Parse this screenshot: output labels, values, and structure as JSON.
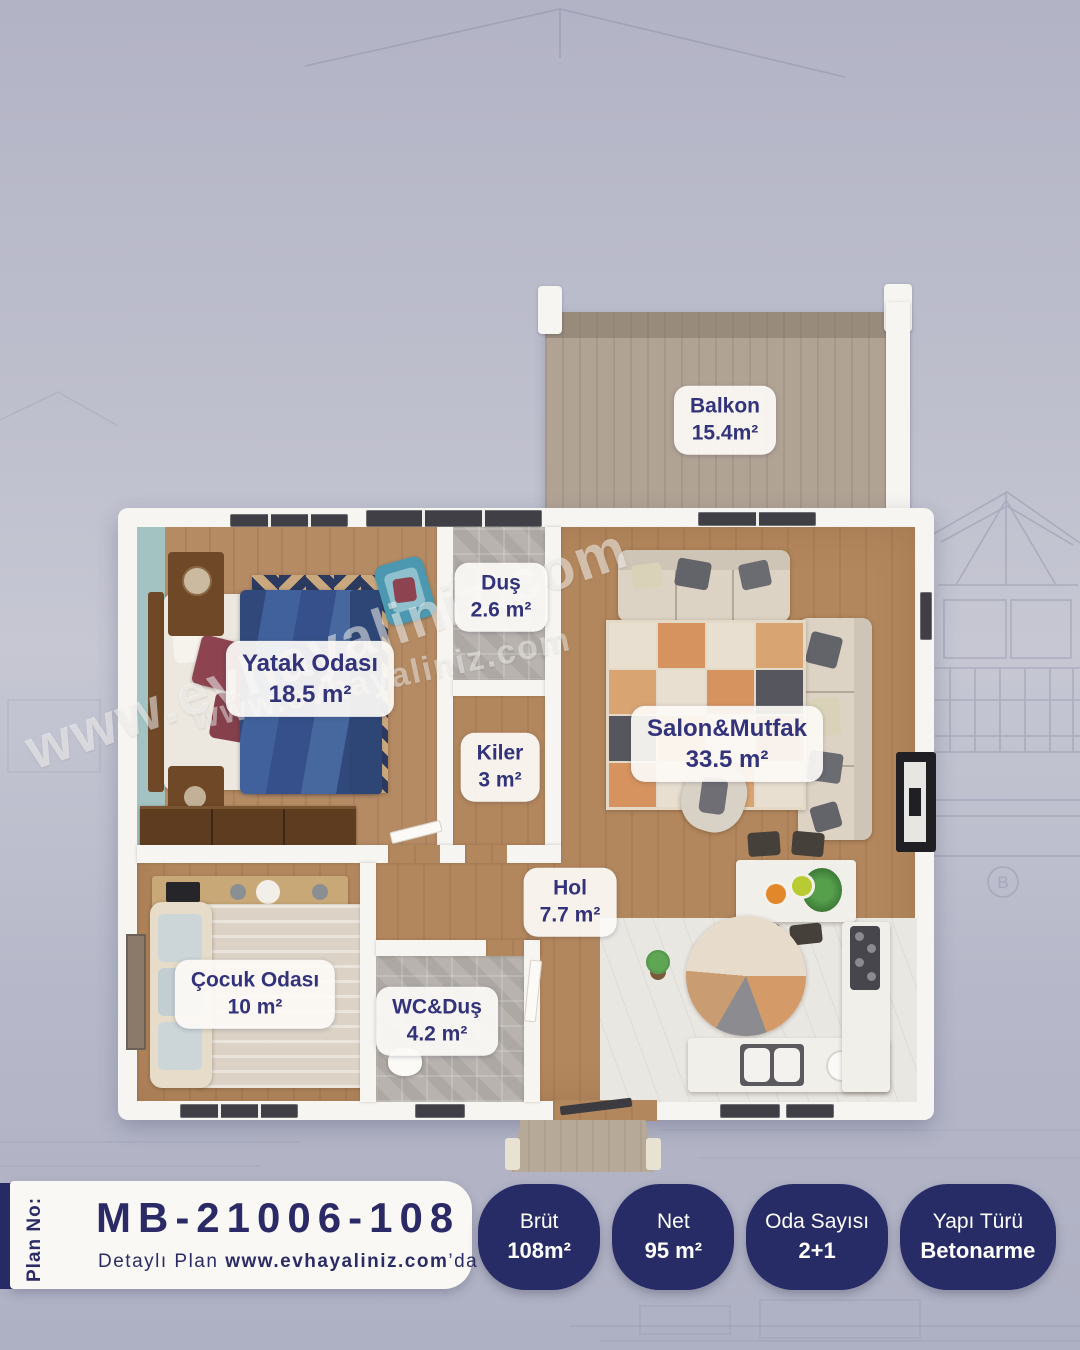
{
  "watermarks": {
    "large": "www.evhayaliniz.com",
    "small": "www.evhayaliniz.com"
  },
  "plan": {
    "rooms": [
      {
        "name": "Balkon",
        "area": "15.4m²"
      },
      {
        "name": "Duş",
        "area": "2.6 m²"
      },
      {
        "name": "Yatak Odası",
        "area": "18.5 m²"
      },
      {
        "name": "Kiler",
        "area": "3 m²"
      },
      {
        "name": "Salon&Mutfak",
        "area": "33.5 m²"
      },
      {
        "name": "Hol",
        "area": "7.7 m²"
      },
      {
        "name": "Çocuk Odası",
        "area": "10 m²"
      },
      {
        "name": "WC&Duş",
        "area": "4.2 m²"
      }
    ]
  },
  "footer": {
    "plan_no_label": "Plan No:",
    "plan_code": "MB-21006-108",
    "detail_prefix": "Detaylı Plan ",
    "detail_site": "www.evhayaliniz.com",
    "detail_suffix": "’da",
    "stats": [
      {
        "label": "Brüt",
        "value": "108m²"
      },
      {
        "label": "Net",
        "value": "95 m²"
      },
      {
        "label": "Oda Sayısı",
        "value": "2+1"
      },
      {
        "label": "Yapı Türü",
        "value": "Betonarme"
      }
    ]
  },
  "colors": {
    "accent_navy": "#272b66",
    "label_text": "#33337c",
    "wood_floor": "#b3875d",
    "wall_white": "#f7f5f1",
    "tile_gray": "#b8b3ae"
  }
}
